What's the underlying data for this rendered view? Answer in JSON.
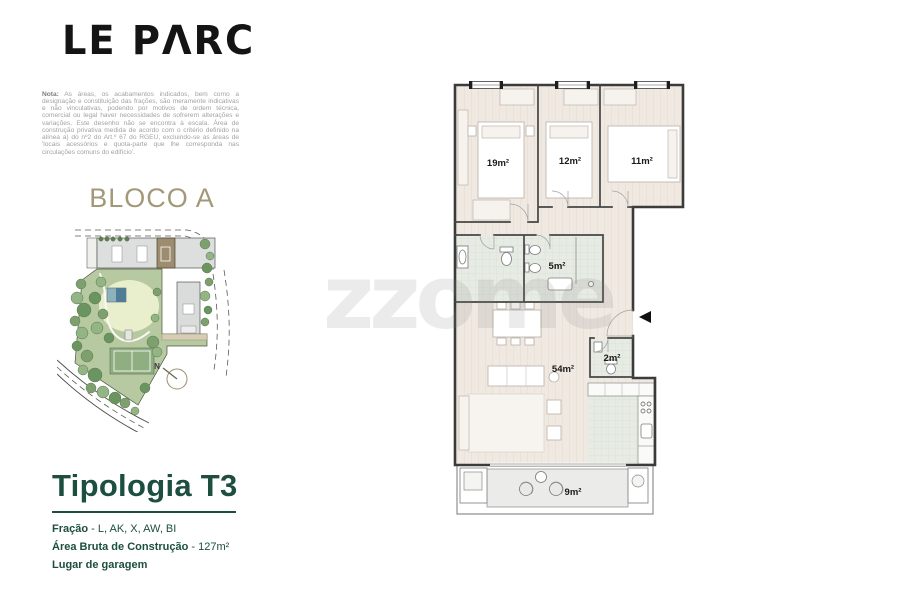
{
  "brand": {
    "logo": "LE PΛRC"
  },
  "note": {
    "label": "Nota:",
    "text": " As áreas, os acabamentos indicados, bem como a designação e constituição das frações, são meramente indicativas e não vinculativas, podendo por motivos de ordem técnica, comercial ou legal haver necessidades de sofrerem alterações e variações. Este desenho não se encontra à escala. Área de construção privativa medida de acordo com o critério definido na alínea a) do nº2 do Art.º 67 do RGEU, excluindo-se as áreas de 'locais acessórios e quota-parte que lhe corresponda nas circulações comuns do edifício'."
  },
  "site_plan": {
    "title": "BLOCO A",
    "compass_label": "N"
  },
  "typology": {
    "title": "Tipologia T3",
    "separator": " - ",
    "details": [
      {
        "label": "Fração",
        "value": "L, AK, X, AW, BI"
      },
      {
        "label": "Área Bruta de Construção",
        "value": "127m²"
      },
      {
        "label": "Lugar de garagem",
        "value": ""
      }
    ]
  },
  "floor_plan": {
    "watermark": "zzome",
    "rooms": [
      {
        "name": "bedroom-1",
        "area": "19m²"
      },
      {
        "name": "bedroom-2",
        "area": "12m²"
      },
      {
        "name": "bedroom-3",
        "area": "11m²"
      },
      {
        "name": "bathroom",
        "area": "5m²"
      },
      {
        "name": "living-room",
        "area": "54m²"
      },
      {
        "name": "wc",
        "area": "2m²"
      },
      {
        "name": "balcony",
        "area": "9m²"
      }
    ]
  },
  "colors": {
    "accent_green": "#1d4e40",
    "accent_tan": "#a39878",
    "floor_beige": "#f0e9e2",
    "floor_green": "#e6ebe3",
    "garden_green": "#b7c9a1"
  }
}
